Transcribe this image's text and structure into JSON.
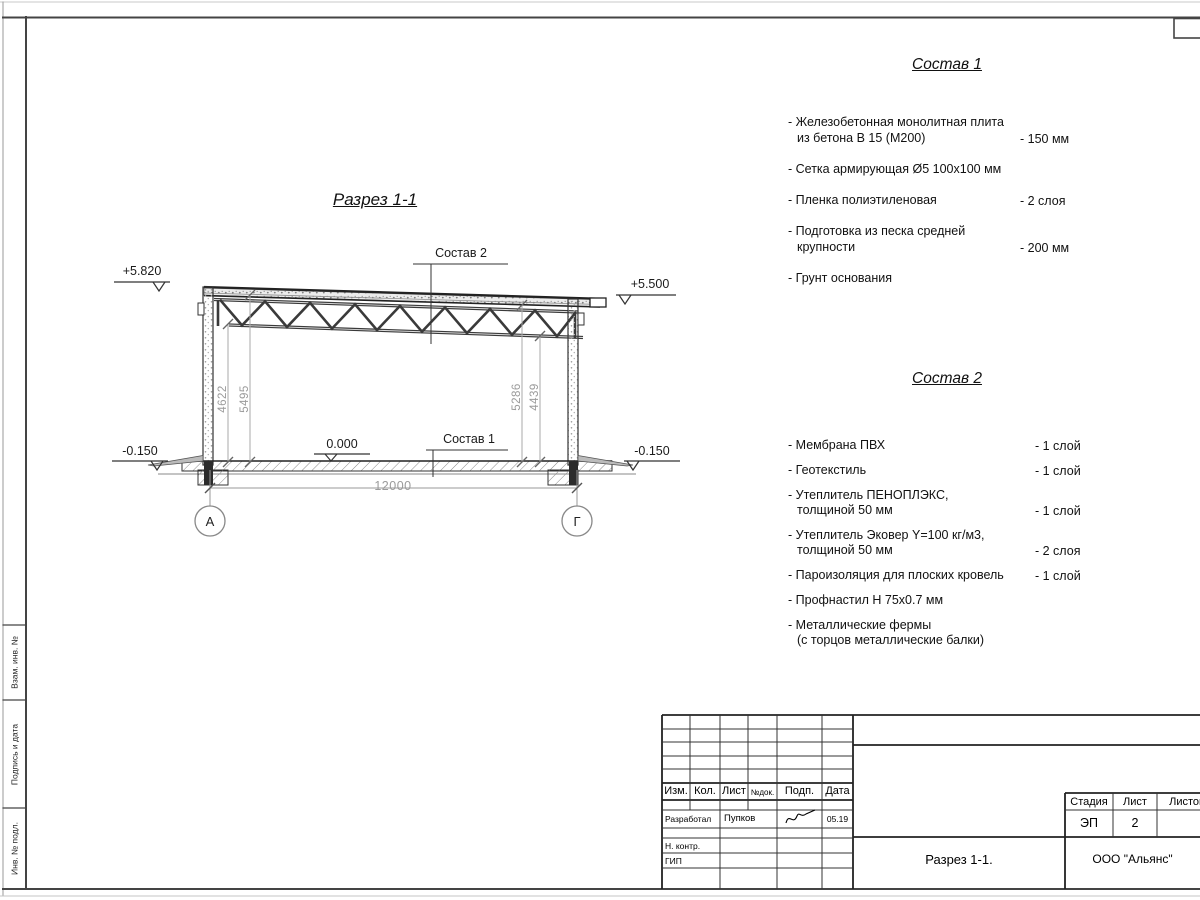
{
  "sheet": {
    "margin_labels": {
      "top": "Взам. инв. №",
      "middle": "Подпись и дата",
      "bottom": "Инв. № подл."
    }
  },
  "section": {
    "title": "Разрез 1-1",
    "leaders": {
      "roof": "Состав 2",
      "floor": "Состав 1"
    },
    "elevations": {
      "top_left": "+5.820",
      "top_right": "+5.500",
      "floor": "0.000",
      "ground_left": "-0.150",
      "ground_right": "-0.150"
    },
    "dims": {
      "h1": "4622",
      "h2": "5495",
      "h3": "5286",
      "h4": "4439",
      "span": "12000"
    },
    "axes": {
      "left": "А",
      "right": "Г"
    }
  },
  "sostav1": {
    "title": "Состав 1",
    "items": [
      {
        "lines": [
          "- Железобетонная  монолитная плита",
          "из бетона В 15 (М200)"
        ],
        "value": "- 150 мм"
      },
      {
        "lines": [
          "- Сетка армирующая Ø5 100х100 мм"
        ],
        "value": ""
      },
      {
        "lines": [
          "- Пленка полиэтиленовая"
        ],
        "value": "-  2 слоя"
      },
      {
        "lines": [
          "- Подготовка из песка средней",
          "крупности"
        ],
        "value": "- 200 мм"
      },
      {
        "lines": [
          "- Грунт основания"
        ],
        "value": ""
      }
    ]
  },
  "sostav2": {
    "title": "Состав 2",
    "items": [
      {
        "lines": [
          "- Мембрана ПВХ"
        ],
        "value": "- 1 слой"
      },
      {
        "lines": [
          "- Геотекстиль"
        ],
        "value": "- 1 слой"
      },
      {
        "lines": [
          "- Утеплитель ПЕНОПЛЭКС,",
          "толщиной 50 мм"
        ],
        "value": "- 1 слой"
      },
      {
        "lines": [
          "- Утеплитель Эковер Y=100 кг/м3,",
          "толщиной 50 мм"
        ],
        "value": "- 2 слоя"
      },
      {
        "lines": [
          "- Пароизоляция для плоских кровель"
        ],
        "value": "- 1 слой"
      },
      {
        "lines": [
          "- Профнастил Н 75х0.7 мм"
        ],
        "value": ""
      },
      {
        "lines": [
          "- Металлические фермы",
          "(с торцов металлические балки)"
        ],
        "value": ""
      }
    ]
  },
  "titleblock": {
    "rev_header": {
      "izm": "Изм.",
      "kol": "Кол.",
      "list": "Лист",
      "ndok": "№док.",
      "podp": "Подп.",
      "data": "Дата"
    },
    "roles": {
      "razrabotal": "Разработал",
      "nkontr": "Н. контр.",
      "gip": "ГИП"
    },
    "values": {
      "surname": "Пупков",
      "date": "05.19"
    },
    "stage_header": {
      "stadia": "Стадия",
      "list": "Лист",
      "listov": "Листов"
    },
    "stage_values": {
      "stadia": "ЭП",
      "list": "2"
    },
    "doc_title": "Разрез 1-1.",
    "company": "ООО \"Альянс\""
  }
}
